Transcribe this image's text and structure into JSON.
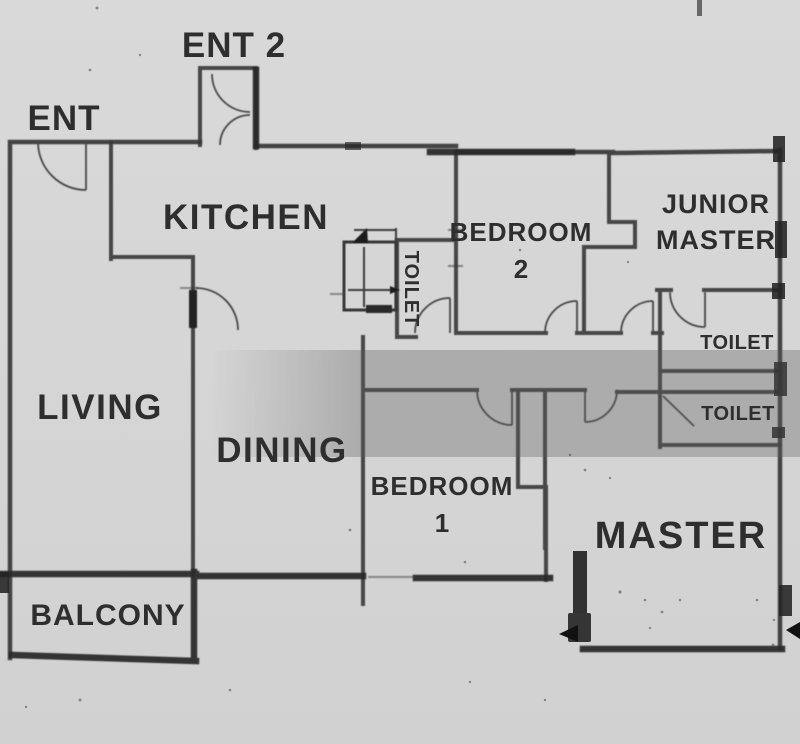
{
  "rooms": {
    "ent": {
      "label": "ENT"
    },
    "ent2": {
      "label": "ENT 2"
    },
    "kitchen": {
      "label": "KITCHEN"
    },
    "living": {
      "label": "LIVING"
    },
    "dining": {
      "label": "DINING"
    },
    "balcony": {
      "label": "BALCONY"
    },
    "bedroom2": {
      "line1": "BEDROOM",
      "line2": "2"
    },
    "bedroom1": {
      "line1": "BEDROOM",
      "line2": "1"
    },
    "junior_master": {
      "line1": "JUNIOR",
      "line2": "MASTER"
    },
    "master": {
      "label": "MASTER"
    },
    "toilet_mid": {
      "label": "TOILET"
    },
    "toilet_upper_right": {
      "label": "TOILET"
    },
    "toilet_lower_right": {
      "label": "TOILET"
    }
  },
  "colors": {
    "background": "#d6d6d6",
    "wall": "#383838",
    "wall_heavy": "#2b2b2b",
    "door": "#474747",
    "label_text": "#2d2d2d",
    "scan_band": "#5e5e5e"
  }
}
